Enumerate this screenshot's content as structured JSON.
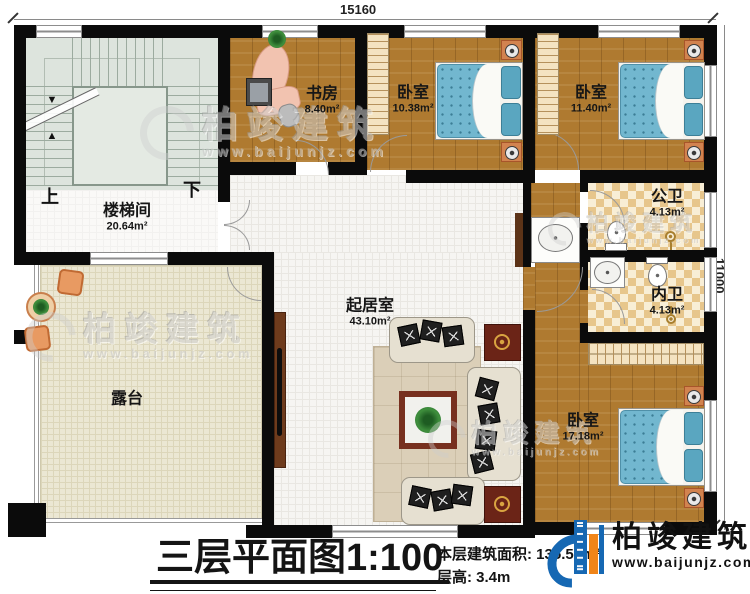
{
  "dimensions": {
    "width": "15160",
    "height": "11000"
  },
  "rooms": {
    "stairwell": {
      "name": "楼梯间",
      "area": "20.64m²"
    },
    "study": {
      "name": "书房",
      "area": "8.40m²"
    },
    "bedroom1": {
      "name": "卧室",
      "area": "10.38m²"
    },
    "bedroom2": {
      "name": "卧室",
      "area": "11.40m²"
    },
    "public_bath": {
      "name": "公卫",
      "area": "4.13m²"
    },
    "private_bath": {
      "name": "内卫",
      "area": "4.13m²"
    },
    "living": {
      "name": "起居室",
      "area": "43.10m²"
    },
    "bedroom3": {
      "name": "卧室",
      "area": "17.18m²"
    },
    "terrace": {
      "name": "露台"
    }
  },
  "stairs": {
    "up": "上",
    "down": "下"
  },
  "title_block": {
    "plan_name": "三层平面图",
    "scale": "1:100",
    "area_label": "本层建筑面积:",
    "area_value": "135.57m²",
    "height_label": "层高:",
    "height_value": "3.4m"
  },
  "brand": {
    "name": "柏竣建筑",
    "website": "www.baijunjz.com"
  },
  "watermark": {
    "name": "柏竣建筑",
    "website": "www.baijunjz.com"
  },
  "colors": {
    "wall": "#0b0b0b",
    "wood_floor": "#af7a30",
    "mattress_blue": "#72b7cf",
    "bath_checker": "#e7c68c",
    "terrace_floor": "#ebe7d3",
    "stair_floor": "#dde4dd",
    "logo_blue": "#1668b3",
    "logo_orange": "#f08519"
  }
}
